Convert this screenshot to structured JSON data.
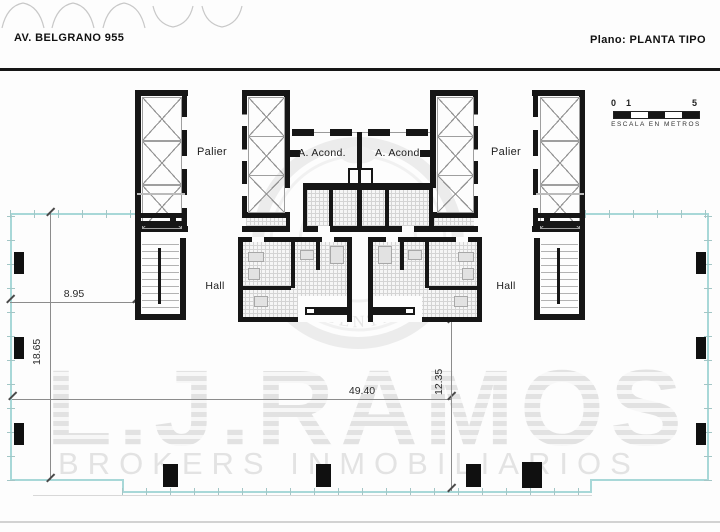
{
  "header": {
    "address": "AV. BELGRANO 955",
    "plan_label": "Plano: PLANTA TIPO"
  },
  "scale_bar": {
    "start": "0",
    "unit": "1",
    "end": "5",
    "caption": "ESCALA EN METROS"
  },
  "rooms": {
    "palier_left": "Palier",
    "palier_right": "Palier",
    "ac_left": "A. Acond.",
    "ac_right": "A. Acond.",
    "hall_left": "Hall",
    "hall_right": "Hall"
  },
  "dimensions": {
    "front_left": "8.95",
    "side_left": "18.65",
    "total_width": "49.40",
    "side_right": "12.35"
  },
  "watermark": {
    "brand": "L.J.RAMOS",
    "subtitle": "BROKERS INMOBILIARIOS",
    "emblem_arc": "ARGENTINA"
  },
  "colors": {
    "wall": "#161616",
    "boundary_line": "#a8d8d8",
    "dimension_line": "#8c8c8c",
    "watermark_gray": "#e7e7e7"
  }
}
